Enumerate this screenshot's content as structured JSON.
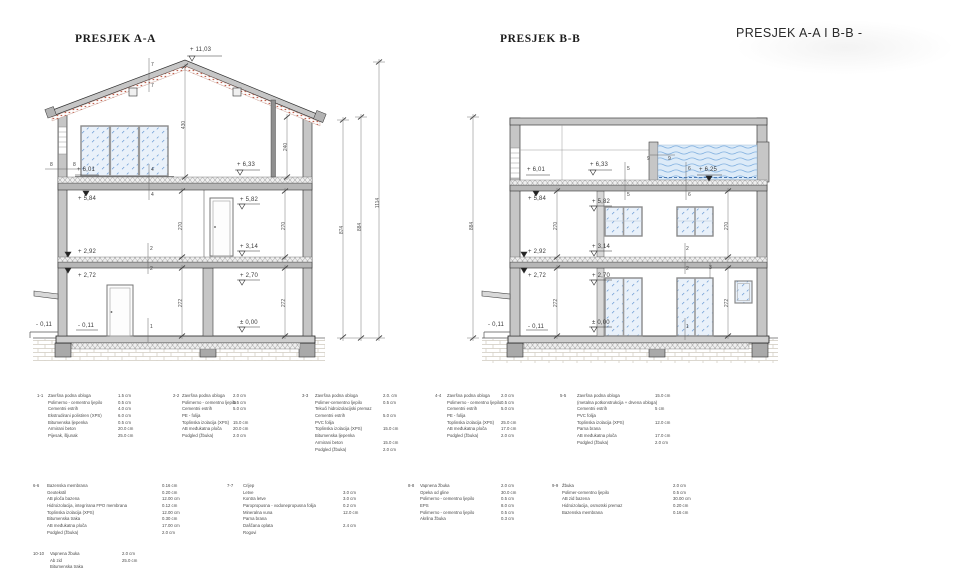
{
  "titles": {
    "section_a": "PRESJEK A-A",
    "section_b": "PRESJEK B-B",
    "combined": "PRESJEK A-A I B-B -"
  },
  "section_a": {
    "levels": {
      "ridge": "+ 11,03",
      "attic_left": "+ 6,01",
      "attic_mid": "+ 6,33",
      "floor2_left": "+ 5,84",
      "floor2_mid": "+ 5,82",
      "slab2_left": "+ 2,92",
      "slab2_mid": "+ 3,14",
      "floor1_left": "+ 2,72",
      "floor1_mid": "+ 2,70",
      "ground_outside": "- 0,11",
      "ground_inside": "- 0,11",
      "zero": "± 0,00"
    },
    "dims": {
      "attic_height": "430",
      "attic_eave": "240",
      "floor2_left": "270",
      "floor2_right": "270",
      "floor1_left": "272",
      "floor1_right": "272",
      "overall_1": "874",
      "overall_2": "884",
      "overall_3": "1114"
    },
    "marks": {
      "roof_upper": "7",
      "roof_lower": "7",
      "wall_out": "8",
      "wall_in": "8",
      "slab_attic_upper": "4",
      "slab_attic_lower": "4",
      "slab2_upper": "2",
      "slab2_lower": "2",
      "floor": "1"
    }
  },
  "section_b": {
    "levels": {
      "attic_left": "+ 6,01",
      "attic_mid": "+ 6,33",
      "pool": "+ 6,25",
      "floor2_left": "+ 5,84",
      "floor2_mid": "+ 5,82",
      "slab2_left": "+ 2,92",
      "slab2_mid": "+ 3,14",
      "floor1_left": "+ 2,72",
      "floor1_mid": "+ 2,70",
      "ground_outside": "- 0,11",
      "ground_inside": "- 0,11",
      "zero": "± 0,00"
    },
    "dims": {
      "overall": "884",
      "floor2_left": "270",
      "floor2_right": "270",
      "floor1_left": "272",
      "floor1_right": "272"
    },
    "marks": {
      "pool_a": "9",
      "pool_b": "9",
      "slab_attic_upper": "5",
      "slab_attic_lower": "5",
      "slab_attic_upper2": "6",
      "slab_attic_lower2": "6",
      "slab2_upper": "2",
      "slab2_lower": "2",
      "floor": "1",
      "window": "3"
    }
  },
  "legend": {
    "g1": {
      "id": "1-1",
      "rows": [
        {
          "name": "Završna podna obloga",
          "value": "1.5 cm"
        },
        {
          "name": "Polimerno - cementno ljepilo",
          "value": "0.5 cm"
        },
        {
          "name": "Cementni estrih",
          "value": "4.0 cm"
        },
        {
          "name": "Ekstrudirani polistiren (XPS)",
          "value": "6.0 cm"
        },
        {
          "name": "Bitumenska ljepenka",
          "value": "0.5 cm"
        },
        {
          "name": "Armirani beton",
          "value": "20.0 cm"
        },
        {
          "name": "Pijesak, šljunak",
          "value": "25.0 cm"
        }
      ]
    },
    "g2": {
      "id": "2-2",
      "rows": [
        {
          "name": "Završna podna obloga",
          "value": "2.0 cm"
        },
        {
          "name": "Polimerno - cementno ljepilo",
          "value": "0.5 cm"
        },
        {
          "name": "Cementni estrih",
          "value": "5.0 cm"
        },
        {
          "name": "PE - folija",
          "value": ""
        },
        {
          "name": "Toplinska izolacija (XPS)",
          "value": "15.0 cm"
        },
        {
          "name": "AB međukatna ploča",
          "value": "20.0 cm"
        },
        {
          "name": "Podgled (žbuka)",
          "value": "2.0 cm"
        }
      ]
    },
    "g3": {
      "id": "3-3",
      "rows": [
        {
          "name": "Završna podna obloga",
          "value": "2.0. cm"
        },
        {
          "name": "Polimer-cementno ljepilo",
          "value": "0.5 cm"
        },
        {
          "name": "Tekući hidroizolacijski premaz",
          "value": ""
        },
        {
          "name": "Cementni estrih",
          "value": "5.0 cm"
        },
        {
          "name": "PVC folija",
          "value": ""
        },
        {
          "name": "Toplinska izolacija (XPS)",
          "value": "15.0 cm"
        },
        {
          "name": "Bitumenska ljepenka",
          "value": ""
        },
        {
          "name": "Armirani beton",
          "value": "15.0 cm"
        },
        {
          "name": "Podgled (žbuka)",
          "value": "2.0 cm"
        }
      ]
    },
    "g4": {
      "id": "4-4",
      "rows": [
        {
          "name": "Završna podna obloga",
          "value": "2.0 cm"
        },
        {
          "name": "Polimerno - cementno ljepilo",
          "value": "0.5 cm"
        },
        {
          "name": "Cementni estrih",
          "value": "5.0 cm"
        },
        {
          "name": "PE - folija",
          "value": ""
        },
        {
          "name": "Toplinska izolacija (XPS)",
          "value": "25.0 cm"
        },
        {
          "name": "AB međukatna ploča",
          "value": "17.0 cm"
        },
        {
          "name": "Podgled (žbuka)",
          "value": "2.0 cm"
        }
      ]
    },
    "g5": {
      "id": "5-5",
      "rows": [
        {
          "name": "Završna podna obloga",
          "value": "15.0 cm"
        },
        {
          "name": "(metalna potkonstrukcija + drvena obloga)",
          "value": ""
        },
        {
          "name": "Cementni estrih",
          "value": "5 cm"
        },
        {
          "name": "PVC folija",
          "value": ""
        },
        {
          "name": "Toplinska izolacija (XPS)",
          "value": "12.0 cm"
        },
        {
          "name": "Parna brana",
          "value": ""
        },
        {
          "name": "AB međukatna ploča",
          "value": "17.0 cm"
        },
        {
          "name": "Podgled (žbuka)",
          "value": "2.0 cm"
        }
      ]
    },
    "g6": {
      "id": "6-6",
      "rows": [
        {
          "name": "Bazenska membrana",
          "value": "0.16 cm"
        },
        {
          "name": "Geotekstil",
          "value": "0.20 cm"
        },
        {
          "name": "AB ploča bazena",
          "value": "12.00 cm"
        },
        {
          "name": "Hidroizolacija, integrirana FPO membrana",
          "value": "0.12 cm"
        },
        {
          "name": "Toplinska izolacija  (XPS)",
          "value": "12.00 cm"
        },
        {
          "name": "Bitumenska traka",
          "value": "0.30 cm"
        },
        {
          "name": "AB međukatna ploča",
          "value": "17.00 cm"
        },
        {
          "name": "Podgled (žbuka)",
          "value": "2.0 cm"
        }
      ]
    },
    "g7": {
      "id": "7-7",
      "rows": [
        {
          "name": "Crijep",
          "value": ""
        },
        {
          "name": "Letve",
          "value": "3.0 cm"
        },
        {
          "name": "Kontra letve",
          "value": "3.0 cm"
        },
        {
          "name": "Paropropusna - vodonepropusna folija",
          "value": "0.2 cm"
        },
        {
          "name": "Mineralna vuna",
          "value": "12.0 cm"
        },
        {
          "name": "Parna brana",
          "value": ""
        },
        {
          "name": "Daščana oplata",
          "value": "2.4 cm"
        },
        {
          "name": "Rogovi",
          "value": ""
        }
      ]
    },
    "g8": {
      "id": "8-8",
      "rows": [
        {
          "name": "Vapnena žbuka",
          "value": "2.0 cm"
        },
        {
          "name": "Opeka od gline",
          "value": "30.0 cm"
        },
        {
          "name": "Polimerno - cementno ljepilo",
          "value": "0.5 cm"
        },
        {
          "name": "EPS",
          "value": "8.0 cm"
        },
        {
          "name": "Polimerno - cementno ljepilo",
          "value": "0.5 cm"
        },
        {
          "name": "Akrilna žbuka",
          "value": "0.3 cm"
        }
      ]
    },
    "g9": {
      "id": "9-9",
      "rows": [
        {
          "name": "Žbuka",
          "value": "2.0 cm"
        },
        {
          "name": "Polimer-cementno ljepilo",
          "value": "0.5 cm"
        },
        {
          "name": "AB zid bazena",
          "value": "30.00 cm"
        },
        {
          "name": "Hidroizolacija, osmotski premaz",
          "value": "0.20 cm"
        },
        {
          "name": "Bazenska membrana",
          "value": "0.16 cm"
        }
      ]
    },
    "g10": {
      "id": "10-10",
      "rows": [
        {
          "name": "Vapnena žbuka",
          "value": "2.0 cm"
        },
        {
          "name": "Ab zid",
          "value": "25.0 cm"
        },
        {
          "name": "Bitumenska traka",
          "value": ""
        },
        {
          "name": "XPS",
          "value": ""
        }
      ]
    }
  }
}
